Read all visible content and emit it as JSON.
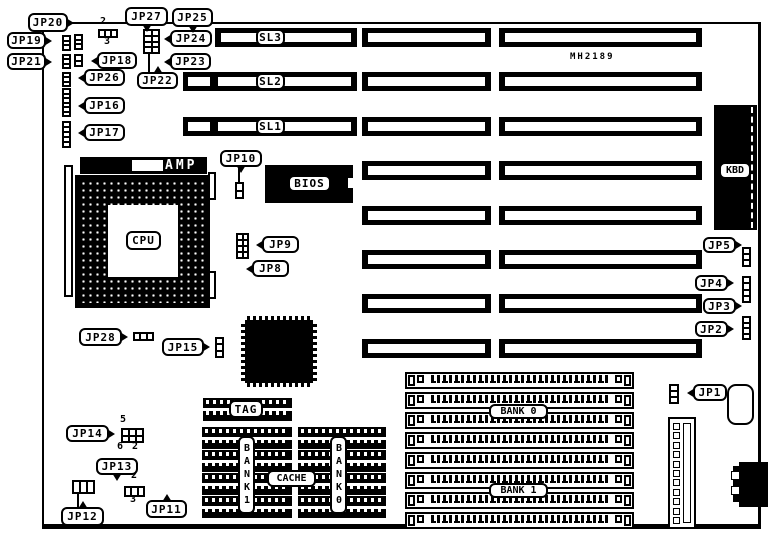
{
  "part_number": "MH2189",
  "colors": {
    "ink": "#000000",
    "paper": "#ffffff"
  },
  "jumper_labels": [
    "JP1",
    "JP2",
    "JP3",
    "JP4",
    "JP5",
    "JP8",
    "JP9",
    "JP10",
    "JP11",
    "JP12",
    "JP13",
    "JP14",
    "JP15",
    "JP16",
    "JP17",
    "JP18",
    "JP19",
    "JP20",
    "JP21",
    "JP22",
    "JP23",
    "JP24",
    "JP25",
    "JP26",
    "JP27",
    "JP28"
  ],
  "slot_labels": [
    "SL3",
    "SL2",
    "SL1"
  ],
  "component_labels": {
    "cpu": "CPU",
    "amp": "AMP",
    "bios": "BIOS",
    "keyboard": "KBD",
    "tag": "TAG",
    "cache": "CACHE",
    "cache_bank_left": "BANK1",
    "cache_bank_right": "BANK0",
    "simm_bank_top": "BANK 0",
    "simm_bank_bottom": "BANK 1"
  },
  "pin_numbers": {
    "jp27": [
      "2",
      "3"
    ],
    "jp14": [
      "5",
      "6",
      "2"
    ],
    "jp11": [
      "2",
      "3"
    ]
  }
}
